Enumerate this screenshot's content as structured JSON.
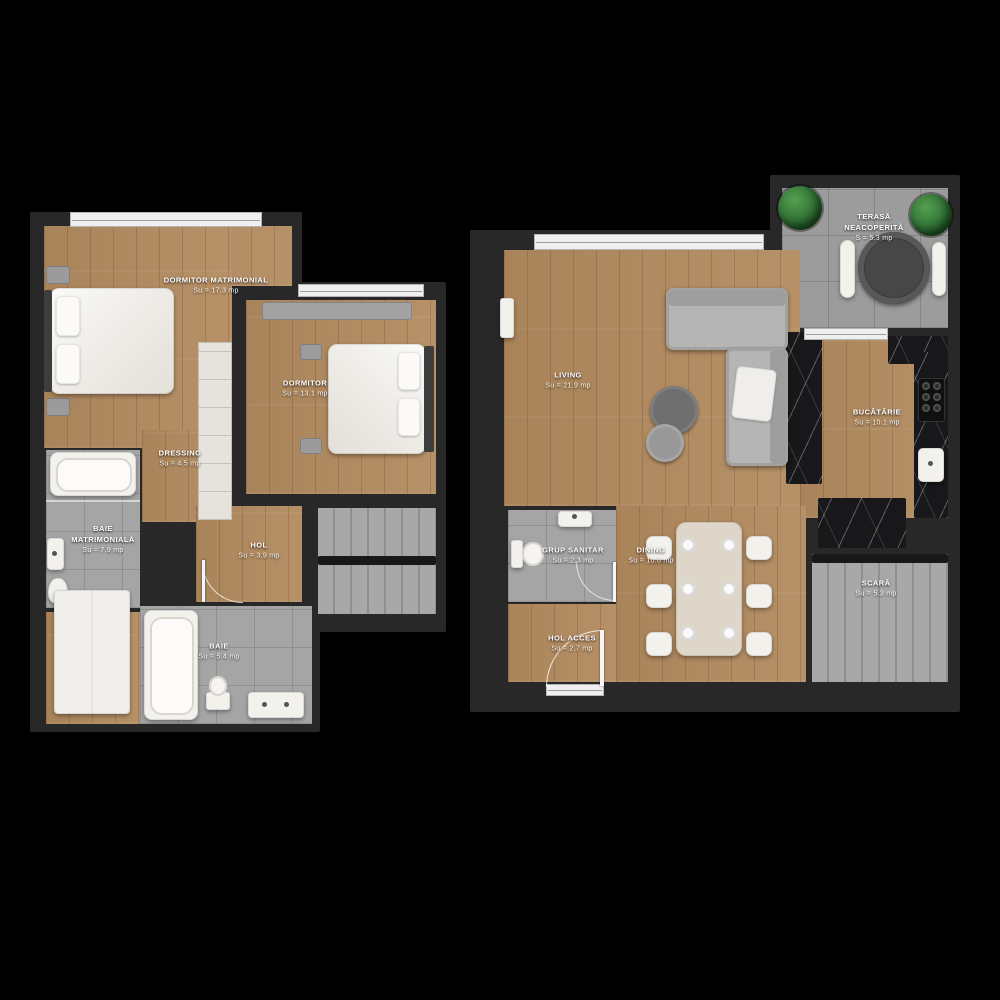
{
  "title": "Duplex apartment floor plans",
  "palette": {
    "background": "#000000",
    "wall": "#282828",
    "wood_floor": "#b28a5e",
    "tile_floor": "#a5a5a5",
    "marble_counter": "#18181b",
    "label_text": "#ffffff",
    "plant_green": "#2e6e33"
  },
  "plans": {
    "upper": {
      "name": "bedroom-level",
      "rooms": [
        {
          "label": "DORMITOR MATRIMONIAL",
          "area": "Su = 17.3 mp"
        },
        {
          "label": "DORMITOR",
          "area": "Su = 13.1 mp"
        },
        {
          "label": "DRESSING",
          "area": "Su = 4.5 mp"
        },
        {
          "label": "BAIE MATRIMONIALĂ",
          "area": "Su = 7.9 mp"
        },
        {
          "label": "HOL",
          "area": "Su = 3.9 mp"
        },
        {
          "label": "BAIE",
          "area": "Su = 5.4 mp"
        }
      ]
    },
    "lower": {
      "name": "living-level",
      "rooms": [
        {
          "label": "TERASĂ NEACOPERITĂ",
          "area": "S = 5.3 mp"
        },
        {
          "label": "LIVING",
          "area": "Su = 21.9 mp"
        },
        {
          "label": "BUCĂTĂRIE",
          "area": "Su = 10.1 mp"
        },
        {
          "label": "GRUP SANITAR",
          "area": "Su = 2.3 mp"
        },
        {
          "label": "DINING",
          "area": "Su = 10.8 mp"
        },
        {
          "label": "HOL ACCES",
          "area": "Su = 2.7 mp"
        },
        {
          "label": "SCARĂ",
          "area": "Su = 5.3 mp"
        }
      ]
    }
  }
}
